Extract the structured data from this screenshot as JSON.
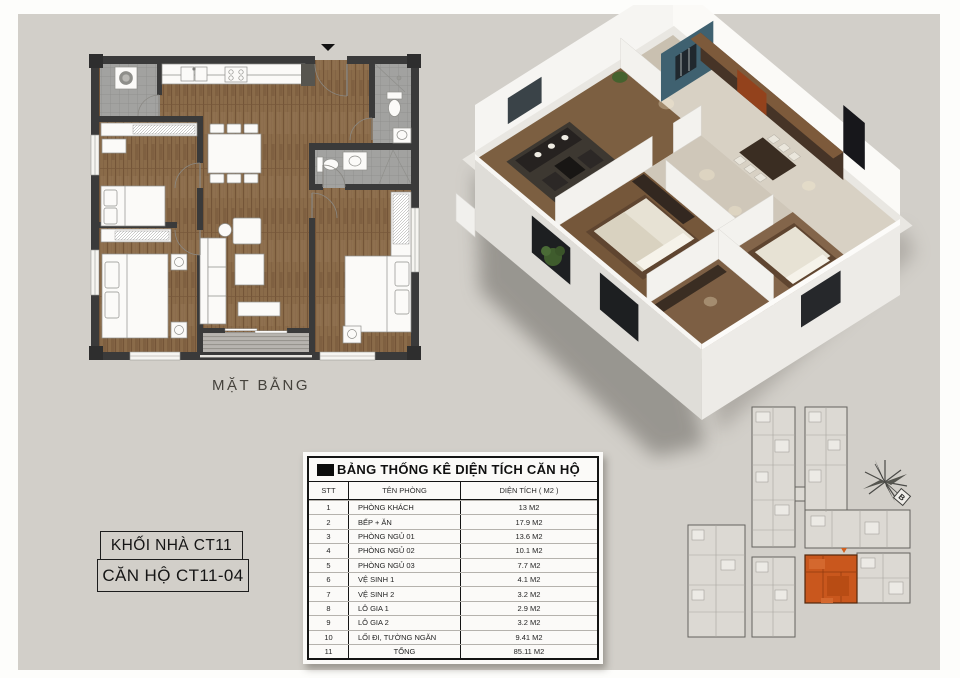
{
  "page": {
    "background": "#d2cfc9",
    "border": "#fdfdfb"
  },
  "floor_plan_2d": {
    "caption": "MẶT BẰNG",
    "icons": [
      "north-arrow-icon",
      "washing-machine-icon",
      "toilet-icon",
      "sink-icon",
      "stove-icon"
    ],
    "colors": {
      "wall": "#3a3a3a",
      "wood_floor": "#8a6b49",
      "tile_floor": "#a0a09e",
      "furniture": "#fbfaf8"
    }
  },
  "floor_plan_3d": {
    "description": "isometric 3d cutaway of apartment",
    "colors": {
      "outer_wall": "#f6f5f2",
      "accent_wall_teal": "#3f6170",
      "wood_floor": "#7c5f41",
      "cabinet": "#463427"
    }
  },
  "unit_labels": {
    "block": "KHỐI NHÀ CT11",
    "unit": "CĂN HỘ CT11-04"
  },
  "area_table": {
    "title": "BẢNG THỐNG KÊ DIỆN TÍCH CĂN HỘ",
    "columns": {
      "stt": "STT",
      "name": "TÊN PHÒNG",
      "area": "DIỆN TÍCH ( M2 )"
    },
    "rows": [
      {
        "stt": "1",
        "name": "PHÒNG KHÁCH",
        "area": "13 M2"
      },
      {
        "stt": "2",
        "name": "BẾP + ĂN",
        "area": "17.9 M2"
      },
      {
        "stt": "3",
        "name": "PHÒNG NGỦ 01",
        "area": "13.6 M2"
      },
      {
        "stt": "4",
        "name": "PHÒNG NGỦ 02",
        "area": "10.1 M2"
      },
      {
        "stt": "5",
        "name": "PHÒNG NGỦ 03",
        "area": "7.7 M2"
      },
      {
        "stt": "6",
        "name": "VỆ SINH 1",
        "area": "4.1 M2"
      },
      {
        "stt": "7",
        "name": "VỆ SINH 2",
        "area": "3.2 M2"
      },
      {
        "stt": "8",
        "name": "LÔ GIA 1",
        "area": "2.9 M2"
      },
      {
        "stt": "9",
        "name": "LÔ GIA 2",
        "area": "3.2 M2"
      },
      {
        "stt": "10",
        "name": "LỐI ĐI, TƯỜNG NGĂN",
        "area": "9.41 M2"
      },
      {
        "stt": "11",
        "name": "TỔNG",
        "area": "85.11 M2",
        "center": true
      }
    ]
  },
  "site_plan": {
    "compass_label": "B",
    "highlight_color": "#c9571d",
    "highlighted_unit": "CT11-04"
  }
}
